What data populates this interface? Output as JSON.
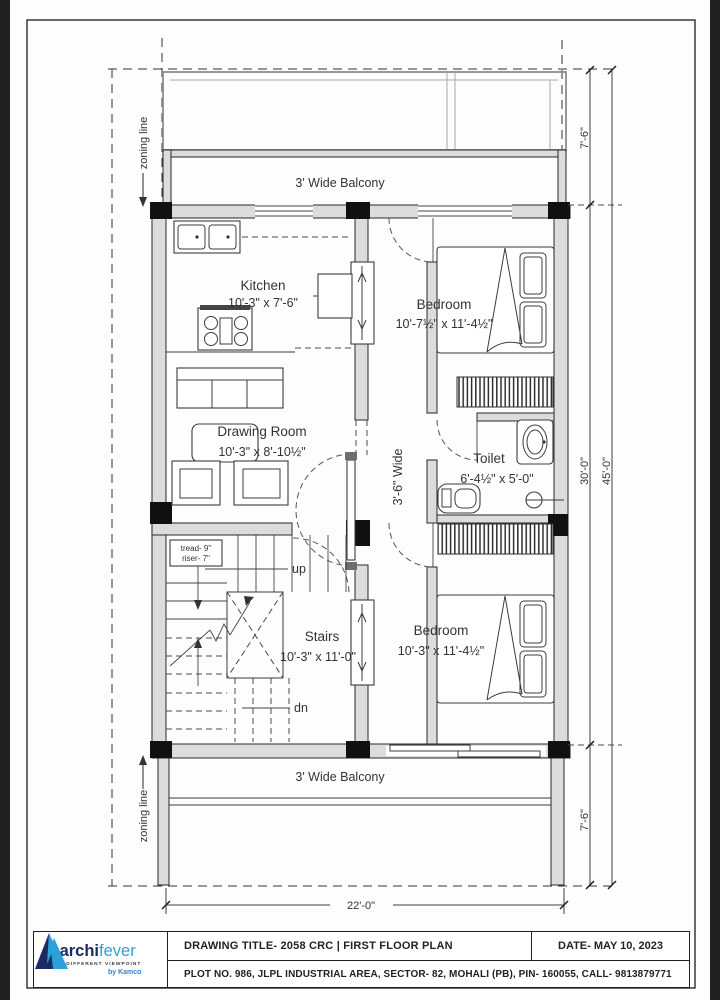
{
  "colors": {
    "line": "#3a3a3a",
    "wall_fill": "#dcdcdc",
    "column": "#101010",
    "scan_edge": "#212121",
    "logo_navy": "#1c2a66",
    "logo_blue": "#2f9fd9"
  },
  "plan": {
    "balcony_top_label": "3' Wide Balcony",
    "balcony_bottom_label": "3' Wide Balcony",
    "passage_label": "3'-6\" Wide",
    "zoning_line_top": "zoning line",
    "zoning_line_bottom": "zoning line",
    "rooms": {
      "kitchen": {
        "name": "Kitchen",
        "dims": "10'-3\" x 7'-6\""
      },
      "bedroom_top": {
        "name": "Bedroom",
        "dims": "10'-7½\" x 11'-4½\""
      },
      "drawing_room": {
        "name": "Drawing Room",
        "dims": "10'-3\" x 8'-10½\""
      },
      "toilet": {
        "name": "Toilet",
        "dims": "6'-4½\" x 5'-0\""
      },
      "stairs": {
        "name": "Stairs",
        "dims": "10'-3\" x 11'-0\""
      },
      "bedroom_bottom": {
        "name": "Bedroom",
        "dims": "10'-3\" x 11'-4½\""
      }
    },
    "stairs_notes": {
      "tread": "tread- 9\"",
      "riser": "riser- 7\"",
      "up": "up",
      "down": "dn"
    },
    "dimensions": {
      "setback_top": "7'-6\"",
      "floor_depth": "30'-0\"",
      "overall_depth": "45'-0\"",
      "setback_bottom": "7'-6\"",
      "overall_width": "22'-0\""
    }
  },
  "title_block": {
    "drawing_title": "DRAWING TITLE- 2058 CRC | FIRST FLOOR PLAN",
    "date": "DATE- MAY 10, 2023",
    "plot_info": "PLOT NO. 986, JLPL INDUSTRIAL AREA, SECTOR- 82, MOHALI (PB), PIN- 160055, CALL- 9813879771"
  },
  "logo": {
    "brand_a": "archi",
    "brand_b": "fever",
    "tagline": "A DIFFERENT VIEWPOINT",
    "byline": "by Kamco"
  }
}
